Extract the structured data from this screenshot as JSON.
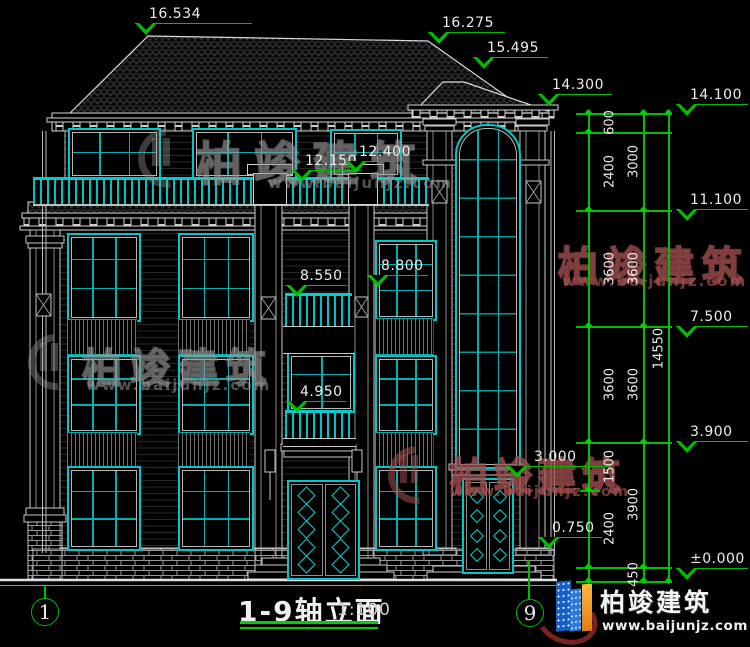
{
  "title_block": {
    "title": "1-9轴立面",
    "scale": "1:100"
  },
  "axis_markers": {
    "left": "1",
    "right": "9"
  },
  "elevation_markers": [
    {
      "id": "roof-peak-left",
      "label": "16.534"
    },
    {
      "id": "roof-ridge-right",
      "label": "16.275"
    },
    {
      "id": "roof-slope",
      "label": "15.495"
    },
    {
      "id": "tower-eave",
      "label": "14.300"
    },
    {
      "id": "main-eave",
      "label": "14.100"
    },
    {
      "id": "terrace-rail-left",
      "label": "12.150"
    },
    {
      "id": "terrace-rail-right",
      "label": "12.400"
    },
    {
      "id": "balcony3-left",
      "label": "8.550"
    },
    {
      "id": "balcony3-right",
      "label": "8.800"
    },
    {
      "id": "level-floor3",
      "label": "11.100"
    },
    {
      "id": "level-floor2",
      "label": "7.500"
    },
    {
      "id": "balcony2",
      "label": "4.950"
    },
    {
      "id": "level-floor1-top",
      "label": "3.900"
    },
    {
      "id": "tower-canopy",
      "label": "3.000"
    },
    {
      "id": "entry-canopy",
      "label": "0.750"
    },
    {
      "id": "ground",
      "label": "±0.000"
    }
  ],
  "dimension_chains": {
    "chain_a": [
      "600",
      "2400",
      "3600",
      "3600",
      "1500",
      "2400"
    ],
    "chain_b": [
      "3000",
      "3600",
      "3600",
      "3900",
      "450"
    ],
    "total": "14550"
  },
  "watermark": {
    "name": "柏竣建筑",
    "url": "www.baijunjz.com"
  },
  "logo": {
    "name": "柏竣建筑",
    "url": "www.baijunjz.com"
  },
  "colors": {
    "background": "#000000",
    "line": "#d9d9d9",
    "glass": "#00c8c8",
    "dimension": "#00bf00",
    "logo_blue": "#1660c4",
    "logo_orange": "#f0952a"
  }
}
